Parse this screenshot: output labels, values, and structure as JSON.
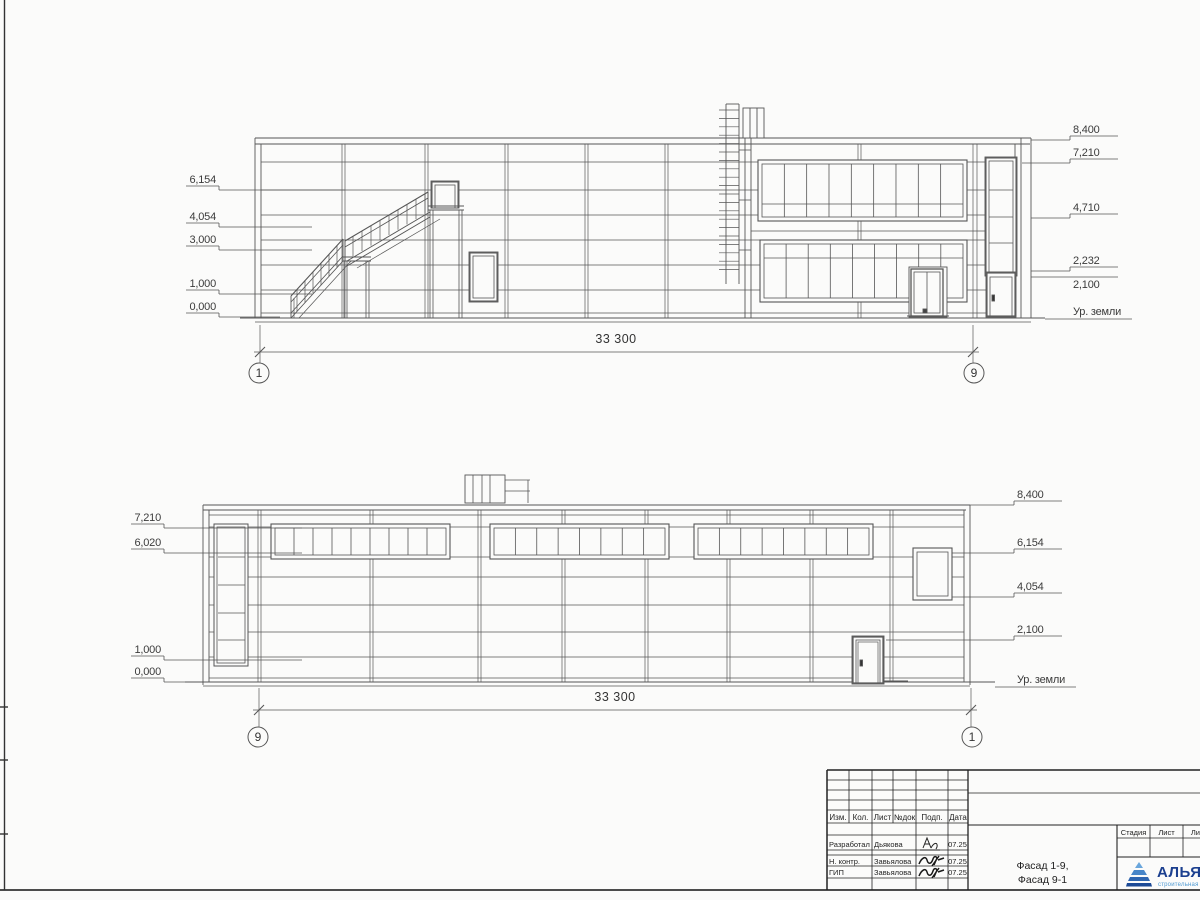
{
  "sheet": {
    "facade_top": {
      "left_marks": [
        "6,154",
        "4,054",
        "3,000",
        "1,000",
        "0,000"
      ],
      "right_marks": [
        "8,400",
        "7,210",
        "4,710",
        "2,232",
        "2,100",
        "Ур. земли"
      ],
      "dimension": "33 300",
      "axis_left": "1",
      "axis_right": "9"
    },
    "facade_bottom": {
      "left_marks": [
        "7,210",
        "6,020",
        "1,000",
        "0,000"
      ],
      "right_marks": [
        "8,400",
        "6,154",
        "4,054",
        "2,100",
        "Ур. земли"
      ],
      "dimension": "33 300",
      "axis_left": "9",
      "axis_right": "1"
    },
    "title_block": {
      "revision_headers": [
        "Изм.",
        "Кол.",
        "Лист",
        "№док",
        "Подп.",
        "Дата"
      ],
      "signature_rows": [
        {
          "role": "Разработал",
          "name": "Дьякова",
          "date": "07.25"
        },
        {
          "role": "Н. контр.",
          "name": "Завьялова",
          "date": "07.25"
        },
        {
          "role": "ГИП",
          "name": "Завьялова",
          "date": "07.25"
        }
      ],
      "stage_headers": [
        "Стадия",
        "Лист",
        "Листов"
      ],
      "drawing_title_line1": "Фасад 1-9,",
      "drawing_title_line2": "Фасад 9-1",
      "company": "АЛЬЯНС",
      "company_subtitle": "строительная компания"
    }
  }
}
